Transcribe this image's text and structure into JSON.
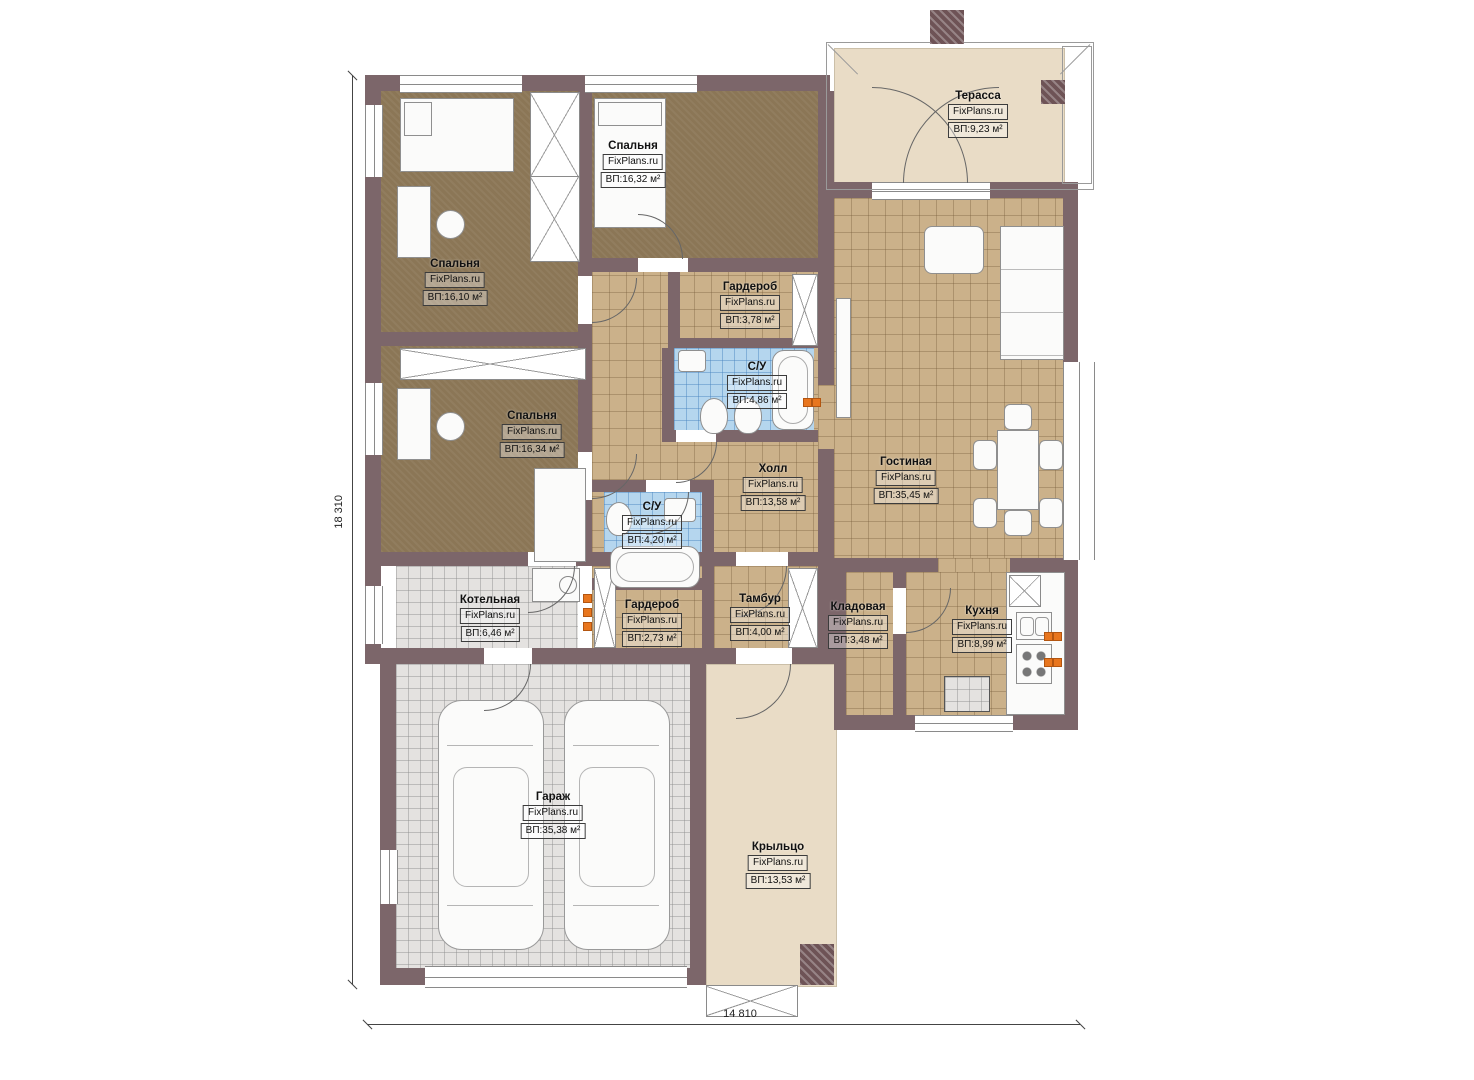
{
  "brand": "FixPlans.ru",
  "dimensions": {
    "height_label": "18 310",
    "width_label": "14 810"
  },
  "rooms": [
    {
      "name": "Спальня",
      "area": "ВП:16,32 м²"
    },
    {
      "name": "Терасса",
      "area": "ВП:9,23 м²"
    },
    {
      "name": "Спальня",
      "area": "ВП:16,10 м²"
    },
    {
      "name": "Гардероб",
      "area": "ВП:3,78 м²"
    },
    {
      "name": "С/У",
      "area": "ВП:4,86 м²"
    },
    {
      "name": "Спальня",
      "area": "ВП:16,34 м²"
    },
    {
      "name": "Холл",
      "area": "ВП:13,58 м²"
    },
    {
      "name": "Гостиная",
      "area": "ВП:35,45 м²"
    },
    {
      "name": "С/У",
      "area": "ВП:4,20 м²"
    },
    {
      "name": "Котельная",
      "area": "ВП:6,46 м²"
    },
    {
      "name": "Гардероб",
      "area": "ВП:2,73 м²"
    },
    {
      "name": "Тамбур",
      "area": "ВП:4,00 м²"
    },
    {
      "name": "Кладовая",
      "area": "ВП:3,48 м²"
    },
    {
      "name": "Кухня",
      "area": "ВП:8,99 м²"
    },
    {
      "name": "Гараж",
      "area": "ВП:35,38 м²"
    },
    {
      "name": "Крыльцо",
      "area": "ВП:13,53 м²"
    }
  ],
  "palette": {
    "wall": "#7c666a",
    "bedroom_floor": "#8b7656",
    "tile_floor": "#cbb18a",
    "bath_tile": "#b5d6ee",
    "garage_tile": "#e4e2e0",
    "deck": "#e9dcc6",
    "outlet": "#e8761e"
  }
}
